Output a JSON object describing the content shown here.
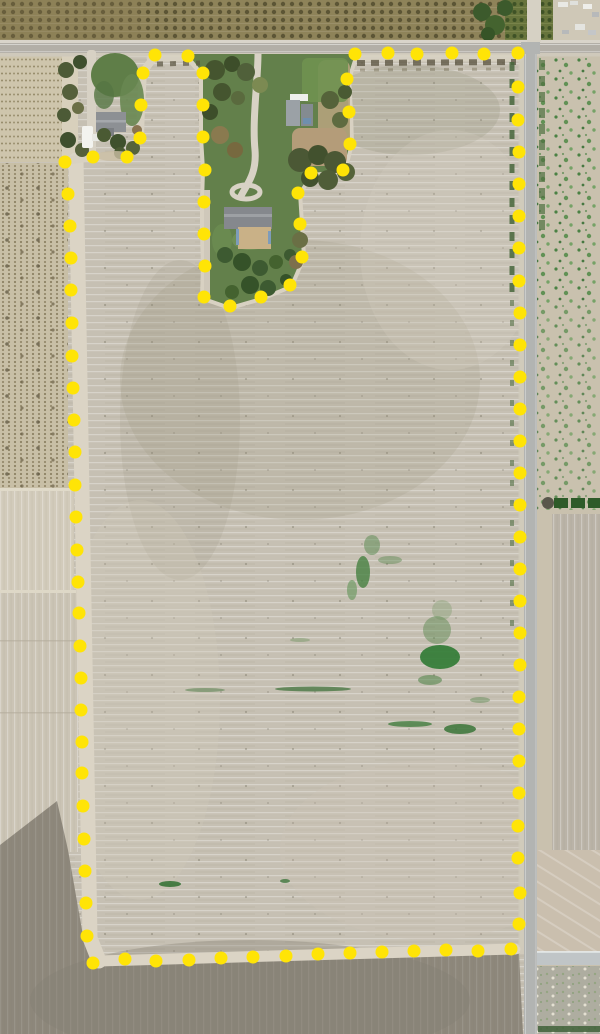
{
  "map": {
    "type": "aerial-parcel-boundary-view",
    "canvas": {
      "width": 600,
      "height": 1034
    },
    "boundary": {
      "marker_color": "#FFE406",
      "marker_radius": 6.5,
      "dots": [
        [
          65,
          162
        ],
        [
          93,
          157
        ],
        [
          127,
          157
        ],
        [
          140,
          138
        ],
        [
          141,
          105
        ],
        [
          143,
          73
        ],
        [
          155,
          55
        ],
        [
          188,
          56
        ],
        [
          203,
          73
        ],
        [
          203,
          105
        ],
        [
          203,
          137
        ],
        [
          205,
          170
        ],
        [
          204,
          202
        ],
        [
          204,
          234
        ],
        [
          205,
          266
        ],
        [
          204,
          297
        ],
        [
          230,
          306
        ],
        [
          261,
          297
        ],
        [
          290,
          285
        ],
        [
          302,
          257
        ],
        [
          300,
          224
        ],
        [
          298,
          193
        ],
        [
          311,
          173
        ],
        [
          343,
          170
        ],
        [
          350,
          144
        ],
        [
          349,
          112
        ],
        [
          347,
          79
        ],
        [
          355,
          54
        ],
        [
          388,
          53
        ],
        [
          417,
          54
        ],
        [
          452,
          53
        ],
        [
          484,
          54
        ],
        [
          518,
          53
        ],
        [
          518,
          87
        ],
        [
          518,
          120
        ],
        [
          519,
          152
        ],
        [
          519,
          184
        ],
        [
          519,
          216
        ],
        [
          519,
          248
        ],
        [
          519,
          281
        ],
        [
          520,
          313
        ],
        [
          520,
          345
        ],
        [
          520,
          377
        ],
        [
          520,
          409
        ],
        [
          520,
          441
        ],
        [
          520,
          473
        ],
        [
          520,
          505
        ],
        [
          520,
          537
        ],
        [
          520,
          569
        ],
        [
          520,
          601
        ],
        [
          520,
          633
        ],
        [
          520,
          665
        ],
        [
          519,
          697
        ],
        [
          519,
          729
        ],
        [
          519,
          761
        ],
        [
          519,
          793
        ],
        [
          518,
          826
        ],
        [
          518,
          858
        ],
        [
          520,
          893
        ],
        [
          519,
          924
        ],
        [
          511,
          949
        ],
        [
          478,
          951
        ],
        [
          446,
          950
        ],
        [
          414,
          951
        ],
        [
          382,
          952
        ],
        [
          350,
          953
        ],
        [
          318,
          954
        ],
        [
          286,
          956
        ],
        [
          253,
          957
        ],
        [
          221,
          958
        ],
        [
          189,
          960
        ],
        [
          156,
          961
        ],
        [
          125,
          959
        ],
        [
          93,
          963
        ],
        [
          87,
          936
        ],
        [
          86,
          903
        ],
        [
          85,
          871
        ],
        [
          84,
          839
        ],
        [
          83,
          806
        ],
        [
          82,
          773
        ],
        [
          82,
          742
        ],
        [
          81,
          710
        ],
        [
          81,
          678
        ],
        [
          80,
          646
        ],
        [
          79,
          613
        ],
        [
          78,
          582
        ],
        [
          77,
          550
        ],
        [
          76,
          517
        ],
        [
          75,
          485
        ],
        [
          75,
          452
        ],
        [
          74,
          420
        ],
        [
          73,
          388
        ],
        [
          72,
          356
        ],
        [
          72,
          323
        ],
        [
          71,
          290
        ],
        [
          71,
          258
        ],
        [
          70,
          226
        ],
        [
          68,
          194
        ]
      ]
    },
    "palette": {
      "parcel_field": "#c6c0b3",
      "orchard_top": "#8e8359",
      "orchard_green": "#67743c",
      "road": "#aeaaa2",
      "dirt_margin": "#dbd4c5",
      "dark_field": "#8d877b",
      "weed_green": "#3e7c3a",
      "homestead_lawn": "#63804b",
      "canal": "#c0c5c7"
    },
    "features": {
      "north_strip": "orchard rows",
      "west_strip": "vineyard rows and open fields",
      "east_strip": "speckled fallow field along county road",
      "southwest": "dark tilled field",
      "center": "large fallow parcel outlined by yellow survey dots",
      "exclusions": "two farmstead home sites notched out of parcel at north end"
    }
  }
}
